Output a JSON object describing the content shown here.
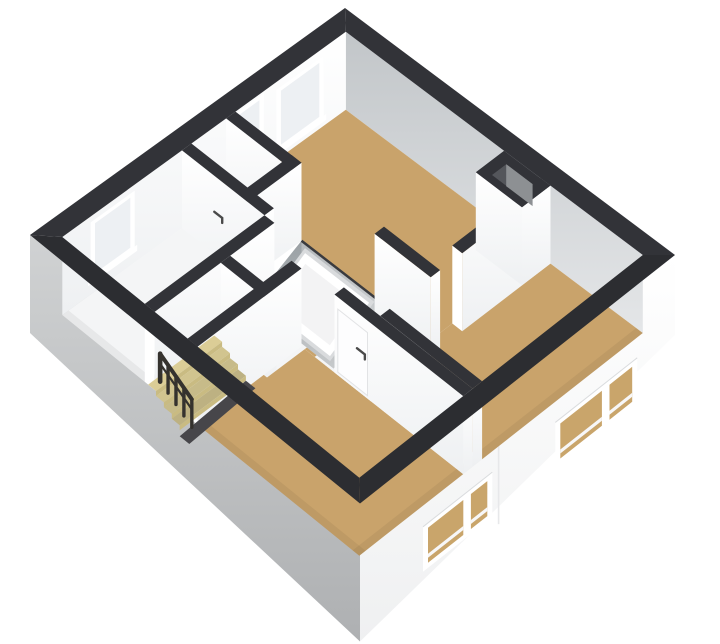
{
  "image_type": "3d-floorplan-render",
  "view": "isometric-top-floor",
  "canvas": {
    "width": 720,
    "height": 644,
    "background": "#ffffff"
  },
  "colors": {
    "wall_top": "#323338",
    "wall_top_dark": "#2c2d31",
    "wall_white_hi": "#ffffff",
    "wall_white_lo": "#eef0f2",
    "wall_gray_hi": "#c2c6c9",
    "wall_gray_lo": "#e4e6e8",
    "floor_wood": "#c9a36b",
    "floor_light": "#f4f5f6",
    "floor_light_lo": "#e7e9ea",
    "stair_wood": "#dbcd96",
    "stair_riser": "#c9bb82",
    "stair_pit": "#47464a",
    "facade_left_hi": "#d0d2d3",
    "facade_left_lo": "#aeb0b2",
    "facade_right_hi": "#ffffff",
    "facade_right_lo": "#eff0f1",
    "pit_deep": "#9aa0a4",
    "pit_light": "#c6c9cb",
    "glazing_interior": "#edf0f3",
    "glazing_facade": "#c9a56b",
    "window_frame": "#ffffff",
    "window_sill": "#f7f7f8",
    "hatch_fill": "#f3f3f4",
    "hatch_frame": "#ffffff",
    "hatch_edge": "#d9dbdd",
    "railing": "#35322e",
    "handle": "#4a4a4a"
  },
  "projection": {
    "origin_x": 345,
    "origin_y": 8,
    "ex": [
      3.3,
      2.47
    ],
    "ey": [
      -3.15,
      2.27
    ],
    "persp_uv": 0.00215,
    "wall_px": 78
  },
  "exterior": {
    "outer": [
      0,
      0,
      100,
      100
    ],
    "inner": [
      5,
      5,
      95,
      95
    ],
    "facade_left_depth": [
      20,
      60
    ],
    "facade_right_depth": [
      2,
      60
    ],
    "facade_seam_v": 56
  },
  "rooms": [
    {
      "name": "bedroom-top",
      "floor": "wood",
      "rect": [
        5,
        5,
        64,
        40
      ]
    },
    {
      "name": "bedroom-right",
      "floor": "wood",
      "rect": [
        64,
        5,
        95,
        56
      ]
    },
    {
      "name": "bedroom-bottom",
      "floor": "wood",
      "rect": [
        43,
        62,
        95,
        95
      ]
    },
    {
      "name": "doorway-gap",
      "floor": "wood",
      "rect": [
        46,
        57,
        56,
        62
      ]
    },
    {
      "name": "hallway-west",
      "floor": "light",
      "rect": [
        5,
        43,
        22,
        54
      ]
    },
    {
      "name": "room-left",
      "floor": "light",
      "rect": [
        5,
        54,
        30,
        95
      ]
    },
    {
      "name": "landing-center",
      "floor": "light",
      "rect": [
        50,
        43,
        67,
        62
      ]
    },
    {
      "name": "landing-south",
      "floor": "light",
      "rect": [
        33,
        59,
        47,
        71
      ]
    },
    {
      "name": "stair-base",
      "floor": "light",
      "rect": [
        31,
        74,
        43,
        95
      ]
    }
  ],
  "interior_walls": [
    {
      "name": "wall-hall-north",
      "dir": "u",
      "rect": [
        5,
        40,
        25,
        43
      ]
    },
    {
      "name": "wall-vide-west",
      "dir": "v",
      "rect": [
        22,
        40,
        25,
        57
      ]
    },
    {
      "name": "wall-leftroom-north",
      "dir": "u",
      "rect": [
        5,
        54,
        30,
        57
      ],
      "door_handle_u": 16
    },
    {
      "name": "wall-leftroom-east",
      "dir": "v",
      "rect": [
        30,
        57,
        33,
        95
      ]
    },
    {
      "name": "wall-toproom-south",
      "dir": "u",
      "rect": [
        50,
        40,
        67,
        43
      ]
    },
    {
      "name": "wall-divider",
      "dir": "v",
      "rect": [
        64,
        5,
        67,
        33
      ]
    },
    {
      "name": "wall-rightroom-south",
      "dir": "u",
      "rect": [
        67,
        56,
        95,
        59
      ]
    },
    {
      "name": "wall-stairs-north",
      "dir": "u",
      "rect": [
        33,
        71,
        47,
        74
      ]
    },
    {
      "name": "wall-stairs-east",
      "dir": "v",
      "rect": [
        43,
        62,
        46,
        95
      ]
    },
    {
      "name": "wall-bottomroom-north",
      "dir": "u",
      "rect": [
        56,
        59,
        95,
        62
      ],
      "door_leaf": [
        57,
        66
      ],
      "door_handle_u": 64
    }
  ],
  "shaft": {
    "outer": [
      53,
      5,
      67,
      14
    ],
    "hole": [
      56,
      7.5,
      64,
      12
    ]
  },
  "vide": {
    "rect": [
      25,
      40,
      50,
      56
    ],
    "depth": 26,
    "hatch": {
      "u1": 27,
      "u2": 48,
      "v1": 41,
      "v2": 55,
      "z_high": 0,
      "z_low": -26
    }
  },
  "stairs": {
    "rect": [
      31,
      74,
      43,
      95
    ],
    "treads": 4,
    "tread_du": 2.4,
    "step_drop": 5,
    "railing": {
      "v": 92,
      "posts": 5,
      "post_height": 28,
      "first_u": 31.8,
      "du": 2.4
    }
  },
  "windows_nw": [
    {
      "name": "window-top-wide",
      "v1": 12,
      "v2": 27,
      "z1": 8,
      "z2": 70
    },
    {
      "name": "window-top-narrow",
      "v1": 31,
      "v2": 40,
      "z1": 20,
      "z2": 76
    },
    {
      "name": "window-left",
      "v1": 72,
      "v2": 86,
      "z1": 14,
      "z2": 72
    }
  ],
  "windows_se": [
    {
      "name": "window-right-room",
      "v1": 12,
      "v2": 38,
      "mullion": 22,
      "z1": 5,
      "z2": -40
    },
    {
      "name": "window-bottom-room",
      "v1": 58,
      "v2": 80,
      "mullion": 66,
      "z1": 5,
      "z2": -40
    }
  ]
}
